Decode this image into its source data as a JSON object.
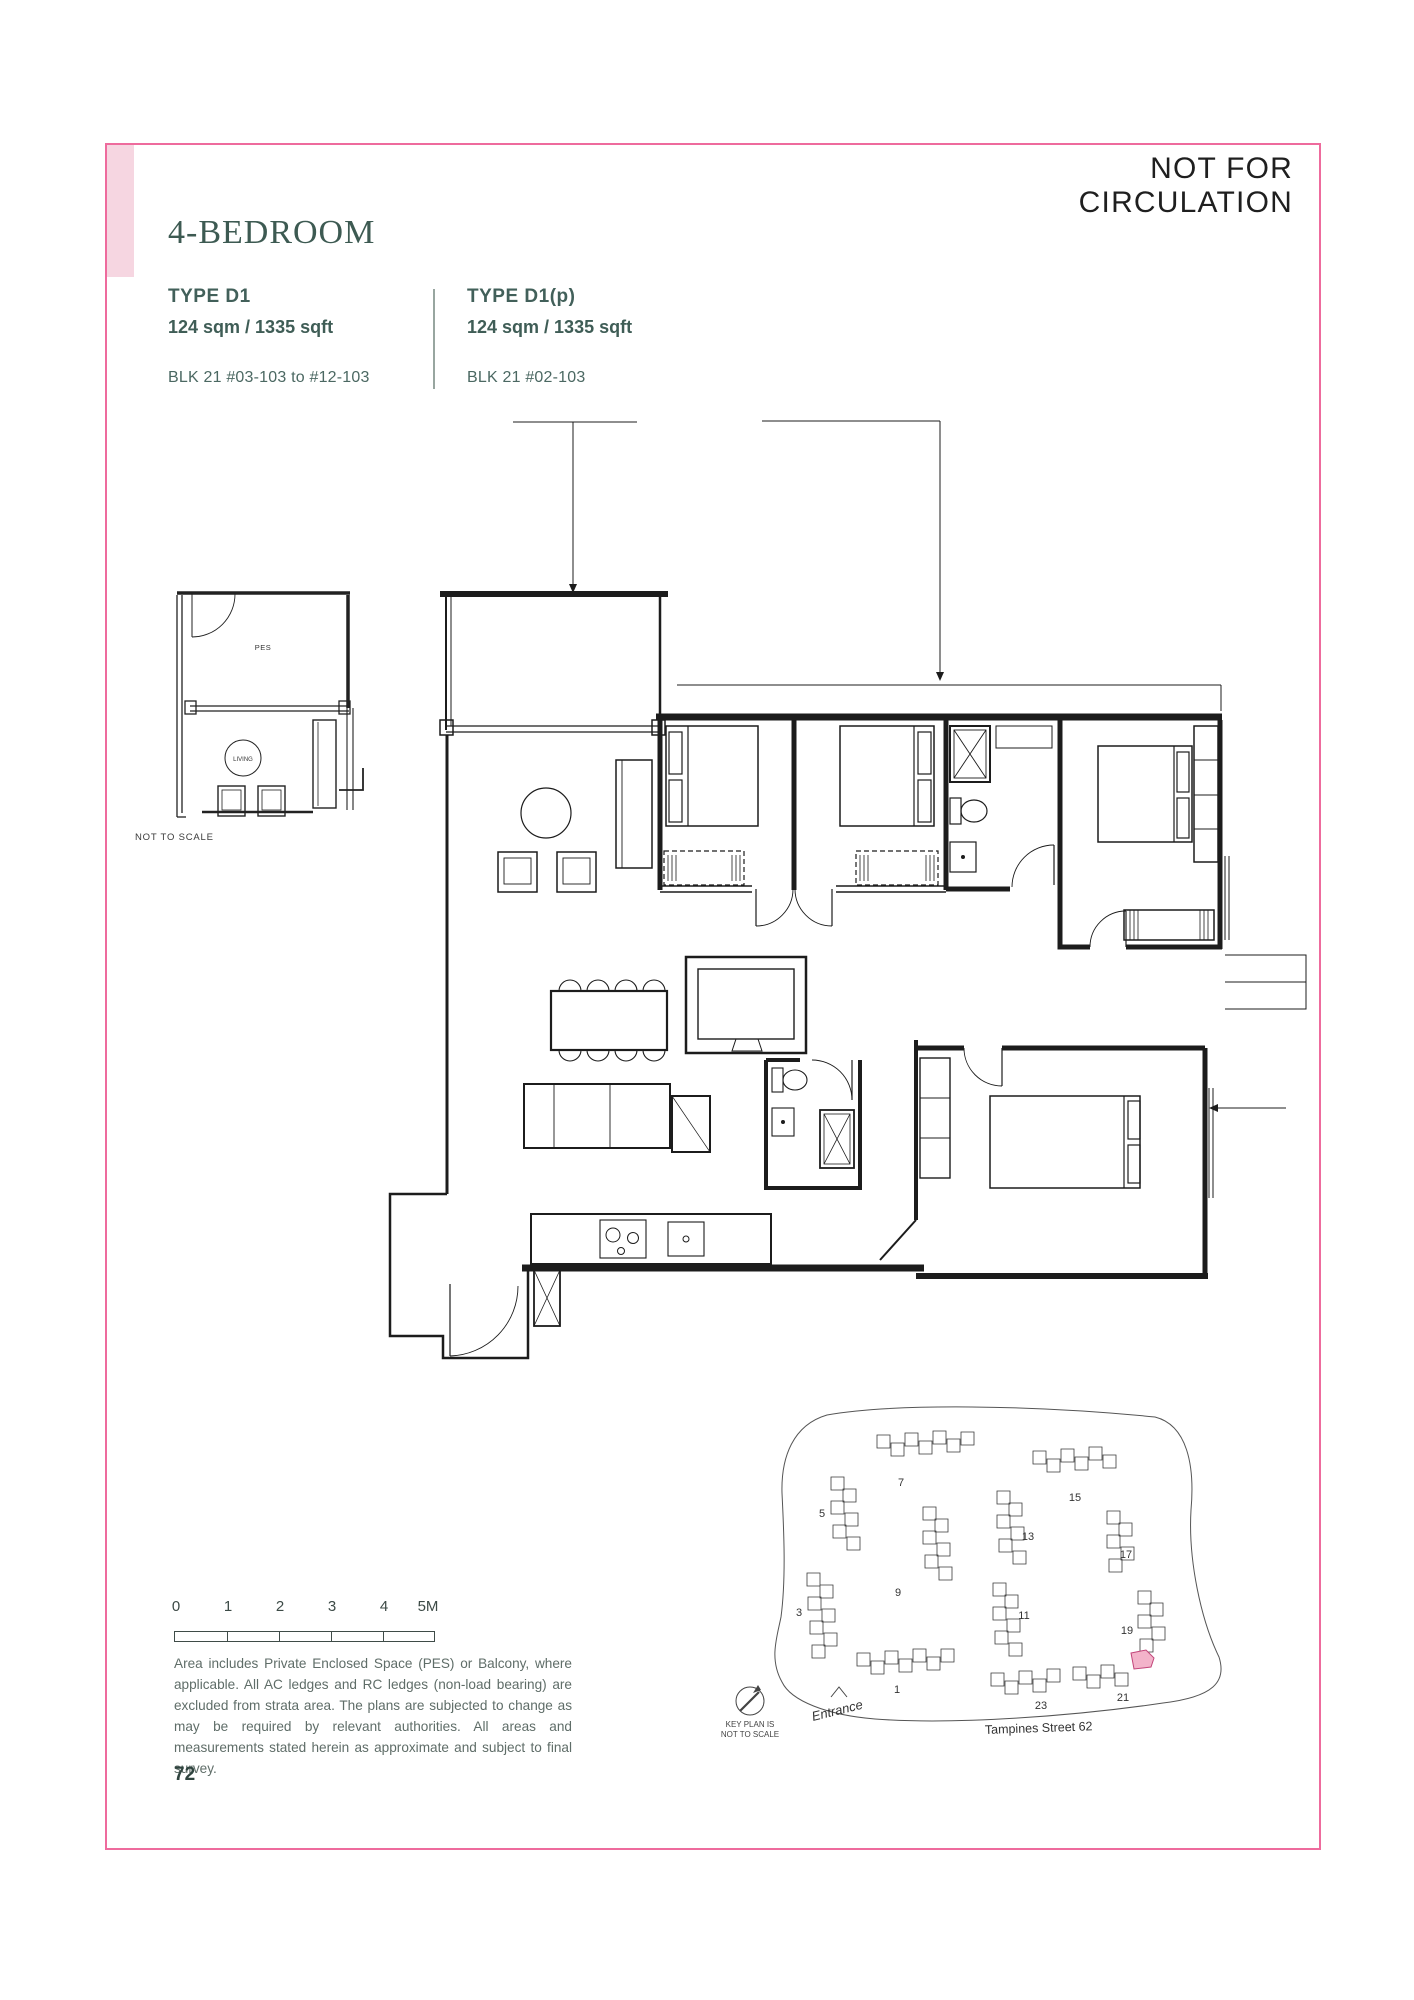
{
  "page": {
    "watermark": "NOT FOR CIRCULATION",
    "title": "4-BEDROOM",
    "page_number": "72"
  },
  "types": [
    {
      "name": "TYPE D1",
      "area": "124 sqm / 1335 sqft",
      "blocks": "BLK 21 #03-103 to #12-103"
    },
    {
      "name": "TYPE D1(p)",
      "area": "124 sqm / 1335 sqft",
      "blocks": "BLK 21 #02-103"
    }
  ],
  "thumbnail": {
    "pes_label": "PES",
    "living_label": "LIVING",
    "note": "NOT TO SCALE"
  },
  "scale_bar": {
    "ticks": [
      "0",
      "1",
      "2",
      "3",
      "4",
      "5M"
    ]
  },
  "disclaimer": "Area includes Private Enclosed Space (PES) or Balcony, where applicable. All AC ledges and RC ledges (non-load bearing) are excluded from strata area. The plans are subjected to change as may be required by relevant authorities. All areas and measurements stated herein as approximate and subject to final survey.",
  "keyplan": {
    "note_line1": "KEY PLAN IS",
    "note_line2": "NOT TO SCALE",
    "entrance_label": "Entrance",
    "street_label": "Tampines Street 62",
    "block_labels": [
      "7",
      "5",
      "3",
      "9",
      "13",
      "15",
      "17",
      "19",
      "11",
      "1",
      "23",
      "21"
    ]
  },
  "colors": {
    "border_pink": "#ee6b9d",
    "corner_pink": "#f6d6e1",
    "heading_teal": "#3d5a52",
    "highlight_pink": "#f3b3ca",
    "plan_line": "#1c1c1c"
  }
}
